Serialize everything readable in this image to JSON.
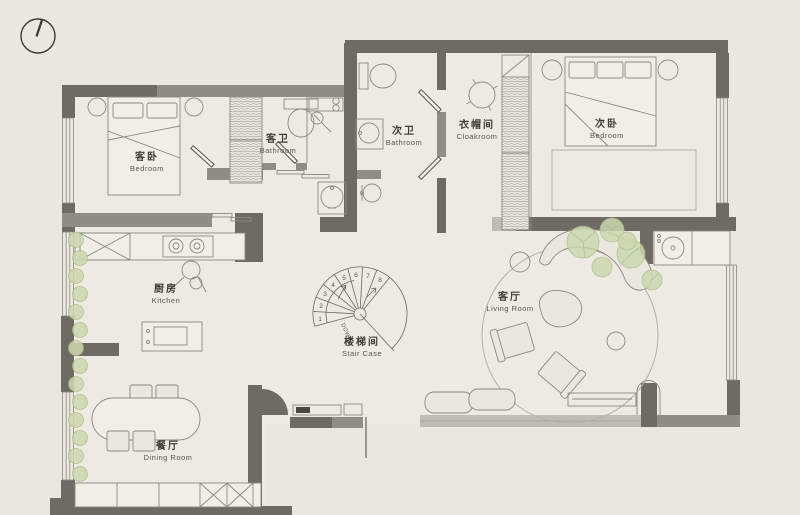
{
  "colors": {
    "bg": "#eae7e0",
    "floor": "#edeae3",
    "wall-dark": "#6e6b65",
    "wall-mid": "#8f8d86",
    "wall-light": "#bfbcb4",
    "line": "#55534e",
    "furn-line": "#8b8880",
    "furn-fill": "#f1eee7",
    "rug-line": "#b3b0a8",
    "plant-fill": "#cdd8b0",
    "plant-line": "#a9bd87",
    "text-primary": "#3f3d38",
    "text-secondary": "#57554f"
  },
  "rooms": [
    {
      "key": "guest-bedroom",
      "name_zh": "客卧",
      "name_en": "Bedroom"
    },
    {
      "key": "guest-bathroom",
      "name_zh": "客卫",
      "name_en": "Bathroom"
    },
    {
      "key": "second-bathroom",
      "name_zh": "次卫",
      "name_en": "Bathroom"
    },
    {
      "key": "cloakroom",
      "name_zh": "衣帽间",
      "name_en": "Cloakroom"
    },
    {
      "key": "second-bedroom",
      "name_zh": "次卧",
      "name_en": "Bedroom"
    },
    {
      "key": "kitchen",
      "name_zh": "厨房",
      "name_en": "Kitchen"
    },
    {
      "key": "staircase",
      "name_zh": "楼梯间",
      "name_en": "Stair Case"
    },
    {
      "key": "living-room",
      "name_zh": "客厅",
      "name_en": "Living Room"
    },
    {
      "key": "dining-room",
      "name_zh": "餐厅",
      "name_en": "Dining Room"
    }
  ],
  "staircase": {
    "steps": [
      "1",
      "2",
      "3",
      "4",
      "5",
      "6",
      "7",
      "8"
    ],
    "direction_label": "DOWN"
  }
}
